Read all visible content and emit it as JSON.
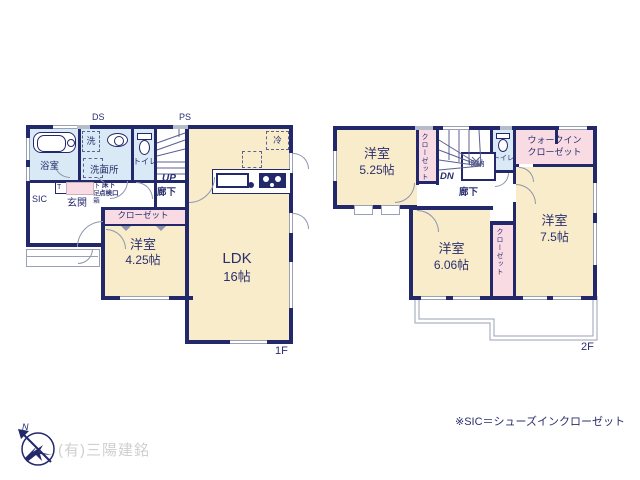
{
  "palette": {
    "wall": "#23286b",
    "room_cream": "#f9ecca",
    "wet_blue": "#d9e9f5",
    "closet_pink": "#f8dbe3",
    "thin_line": "#9aa0b5",
    "company_gray": "#cfcfcf"
  },
  "floor1": {
    "floor_label": "1F",
    "ds": "DS",
    "ps": "PS",
    "bath": "浴室",
    "washer": "洗",
    "washroom": "洗面所",
    "toilet": "トイレ",
    "up": "UP",
    "hall": "廊下",
    "inspection_l1": "床下",
    "inspection_l2": "点検口",
    "t_mark": "T",
    "shoebox": "下足箱",
    "entrance": "玄関",
    "sic": "SIC",
    "closet": "クローゼット",
    "room425_name": "洋室",
    "room425_size": "4.25帖",
    "ldk_name": "LDK",
    "ldk_size": "16帖",
    "fridge": "冷"
  },
  "floor2": {
    "floor_label": "2F",
    "dn": "DN",
    "hall": "廊下",
    "storage": "収納",
    "toilet": "トイレ",
    "closet_a": "クローゼット",
    "closet_b": "クローゼット",
    "wic_l1": "ウォークイン",
    "wic_l2": "クローゼット",
    "room525_name": "洋室",
    "room525_size": "5.25帖",
    "room606_name": "洋室",
    "room606_size": "6.06帖",
    "room75_name": "洋室",
    "room75_size": "7.5帖"
  },
  "footer": {
    "note": "※SIC＝シューズインクローゼット",
    "company": "(有)三陽建銘",
    "north": "N"
  }
}
